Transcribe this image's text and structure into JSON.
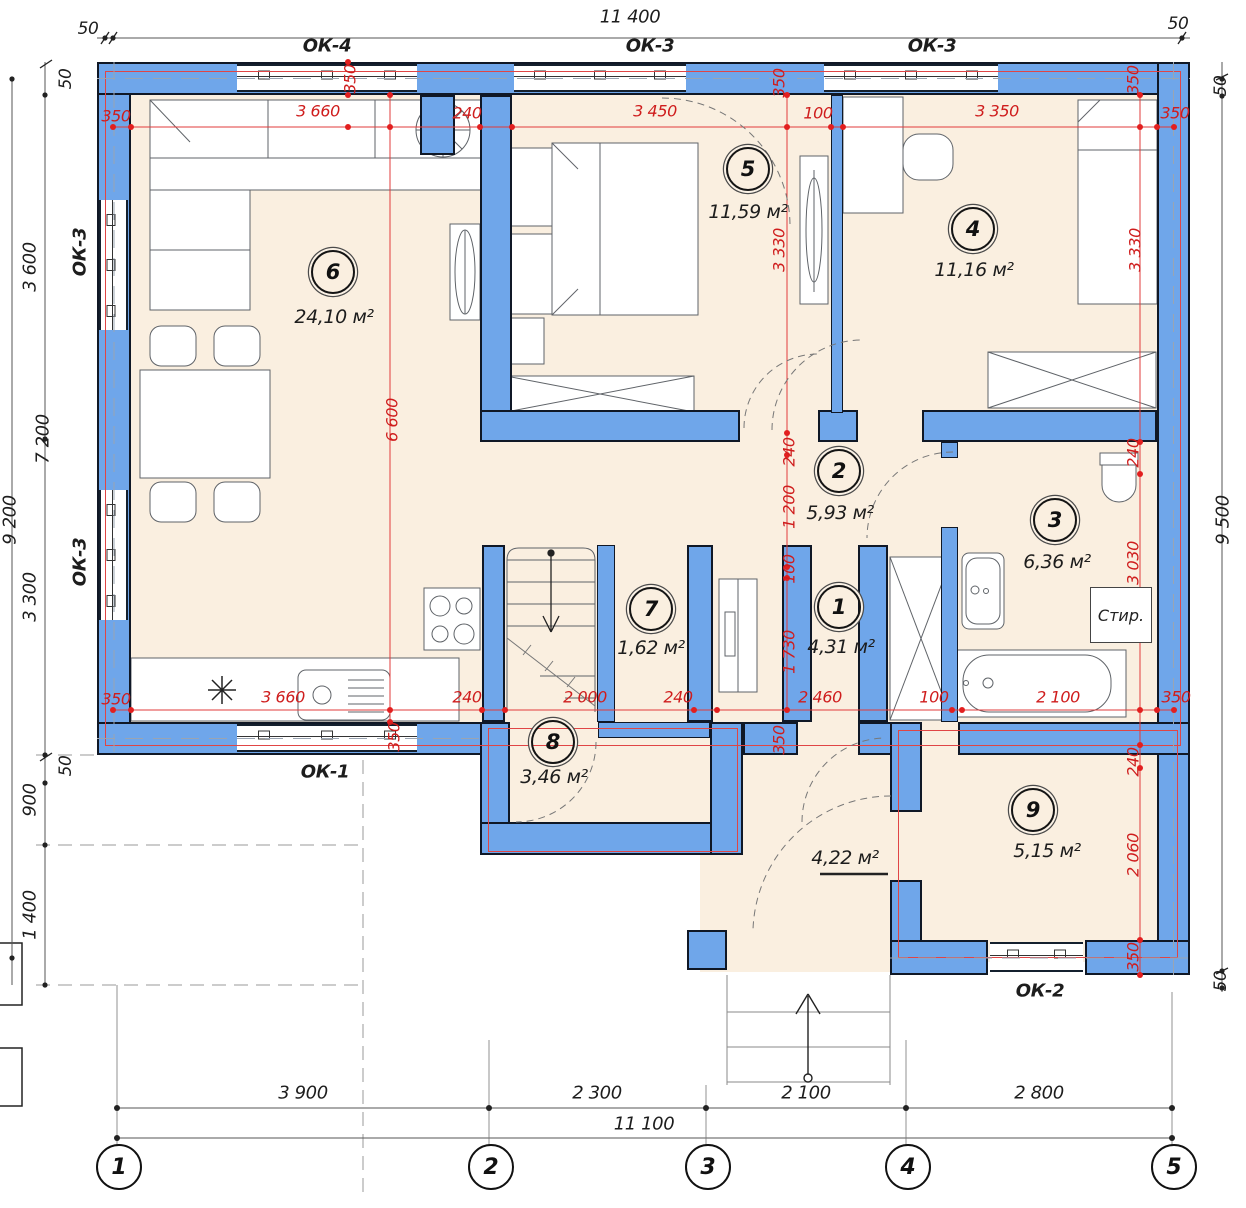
{
  "meta": {
    "drawing_type": "architectural floor plan"
  },
  "colors": {
    "wall_fill": "#6fa6ea",
    "wall_edge": "#101826",
    "room_fill": "#faefe0",
    "dim_red": "#cf1d1d",
    "line_dark": "#333333"
  },
  "rooms": [
    {
      "num": "1",
      "area": "4,31 м²"
    },
    {
      "num": "2",
      "area": "5,93 м²"
    },
    {
      "num": "3",
      "area": "6,36 м²"
    },
    {
      "num": "4",
      "area": "11,16 м²"
    },
    {
      "num": "5",
      "area": "11,59 м²"
    },
    {
      "num": "6",
      "area": "24,10 м²"
    },
    {
      "num": "7",
      "area": "1,62 м²"
    },
    {
      "num": "8",
      "area": "3,46 м²"
    },
    {
      "num": "9",
      "area": "5,15 м²"
    }
  ],
  "hall_area": "4,22 м²",
  "labels": {
    "washer": "Стир."
  },
  "windows": [
    "ОК-4",
    "ОК-3",
    "ОК-3",
    "ОК-3",
    "ОК-3",
    "ОК-1",
    "ОК-2"
  ],
  "axes": [
    "1",
    "2",
    "3",
    "4",
    "5"
  ],
  "outer_dims": {
    "top": [
      "50",
      "11 400",
      "50"
    ],
    "left": [
      "50",
      "3 600",
      "7 200",
      "9 200",
      "3 300",
      "50",
      "900",
      "1 400"
    ],
    "right": [
      "50",
      "9 500",
      "50"
    ],
    "bottom": [
      "3 900",
      "2 300",
      "2 100",
      "2 800",
      "11 100"
    ]
  },
  "red_dims": {
    "top": [
      "350",
      "3 660",
      "240",
      "3 450",
      "100",
      "3 350",
      "350"
    ],
    "top_wall": [
      "350",
      "350",
      "350"
    ],
    "bottom": [
      "350",
      "3 660",
      "240",
      "2 000",
      "240",
      "2 460",
      "100",
      "2 100",
      "350"
    ],
    "bottom_wall": [
      "350",
      "350"
    ],
    "left_mid": [
      "6 600"
    ],
    "mid_walls": [
      "3 330",
      "3 330"
    ],
    "center": [
      "240",
      "1 200",
      "100",
      "1 730"
    ],
    "right": [
      "240",
      "3 030",
      "240",
      "2 060",
      "350"
    ]
  }
}
